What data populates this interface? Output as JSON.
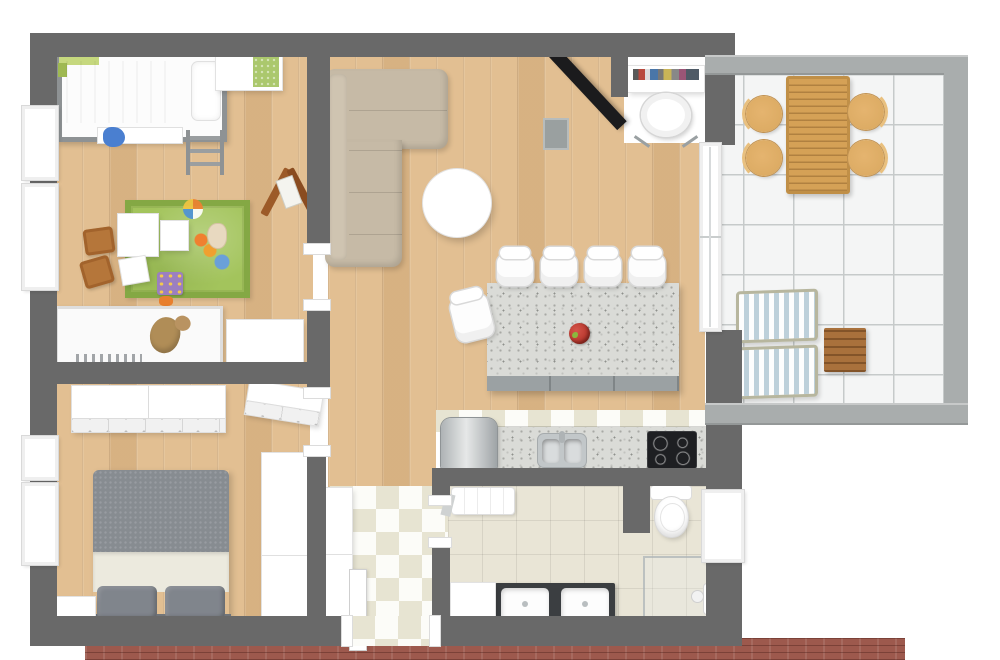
{
  "scene": {
    "kind": "3D floor plan, top-down render",
    "width_px": 1000,
    "height_px": 660,
    "background": "#ffffff"
  },
  "palette": {
    "wall": "#696969",
    "patio-wall": "#a9adad",
    "wood": "#e2bf92",
    "checker-dark": "#e7e4d2",
    "bath-tile": "#e9e5d6",
    "patio-tile": "#f4f5f5",
    "rug": "#a3c45c",
    "sofa": "#c6baa6",
    "island": "#dadbd7",
    "brick": "#9d594d",
    "door": "#1b1b1d",
    "duvet": "#878c91",
    "chair-wood": "#d9a85f",
    "lounger-stripe": "#bdd0da",
    "table-wood": "#d5a156",
    "side-table": "#a9713c",
    "fruit": "#b5342a"
  },
  "floor_plan": {
    "rooms": [
      {
        "name": "kids-bedroom",
        "position": "top-left",
        "floor": "light wood planks",
        "furniture": [
          "loft bed with white duvet and green headboard",
          "ladder",
          "white desk with green mat",
          "wooden easel",
          "green play rug with scattered toys",
          "two small wooden chairs",
          "toddler bed with teddy bear",
          "white cabinet"
        ]
      },
      {
        "name": "living-room",
        "position": "top-center",
        "floor": "light wood planks",
        "furniture": [
          "beige corner sofa",
          "round white coffee table",
          "open black front door",
          "entry desk with colorful books",
          "white swivel chair",
          "glass sliding doors to patio"
        ]
      },
      {
        "name": "kitchen",
        "position": "center",
        "floor": "checkerboard tile strip",
        "furniture": [
          "granite island",
          "four white bar stools",
          "one white stool at side",
          "red fruit bowl",
          "stainless fridge",
          "granite counter",
          "stainless double sink",
          "black cooktop with four burners"
        ]
      },
      {
        "name": "master-bedroom",
        "position": "bottom-left",
        "floor": "light wood planks",
        "furniture": [
          "double bed with gray duvet and two gray pillows",
          "white dresser row",
          "angled white dresser",
          "tall white wardrobe",
          "white nightstand"
        ]
      },
      {
        "name": "hallway",
        "position": "bottom-center",
        "floor": "white-cream checkerboard",
        "furniture": [
          "white closets",
          "entry door with white leaf and threshold"
        ]
      },
      {
        "name": "bathroom",
        "position": "bottom-right",
        "floor": "beige tile",
        "furniture": [
          "toilet",
          "white radiator shelf",
          "dark double vanity with two white sinks",
          "white cabinet",
          "glass shower with fixture",
          "window"
        ]
      },
      {
        "name": "patio",
        "position": "right",
        "floor": "large white tiles with gray joints",
        "furniture": [
          "slatted wooden dining table",
          "four round wooden chairs",
          "two blue-striped loungers",
          "square wooden side table"
        ]
      }
    ],
    "structure": [
      "dark gray exterior and interior walls",
      "white framed windows on left wall",
      "brick footing along bottom edge",
      "light gray patio parapet walls"
    ]
  }
}
